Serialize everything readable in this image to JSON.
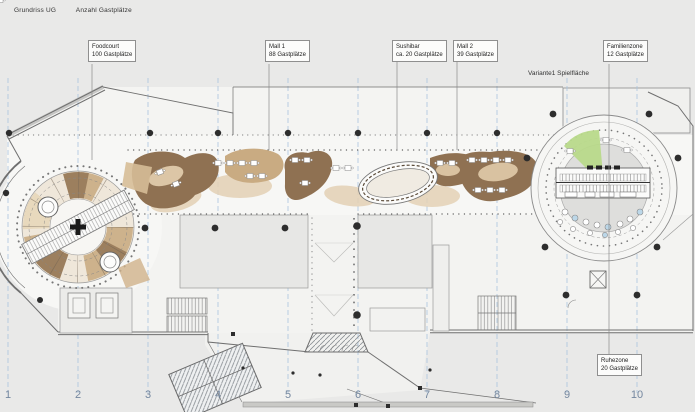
{
  "title": {
    "main": "Grundriss UG",
    "sub": "Anzahl Gastplätze"
  },
  "annotations": [
    {
      "id": "foodcourt",
      "line1": "Foodcourt",
      "line2": "100 Gastplätze"
    },
    {
      "id": "mall1",
      "line1": "Mall 1",
      "line2": "88 Gastplätze"
    },
    {
      "id": "sushibar",
      "line1": "Sushibar",
      "line2": "ca. 20 Gastplätze"
    },
    {
      "id": "mall2",
      "line1": "Mall 2",
      "line2": "39 Gastplätze"
    },
    {
      "id": "familienzone",
      "line1": "Familienzone",
      "line2": "12 Gastplätze"
    },
    {
      "id": "ruhezone",
      "line1": "Ruhezone",
      "line2": "20 Gastplätze"
    }
  ],
  "variant_note": "Variante1  Spielfläche",
  "axis_labels": [
    "1",
    "2",
    "3",
    "4",
    "5",
    "6",
    "7",
    "8",
    "9",
    "10"
  ],
  "colors": {
    "background": "#e9e9e8",
    "plan_white": "#f7f7f5",
    "grid_blue": "#a9c4de",
    "axis_number_blue": "#74879f",
    "column_black": "#2d2d2d",
    "furniture_dark_brown": "#8f7152",
    "furniture_mid_brown": "#c9ab82",
    "furniture_light_tan": "#e4d1b5",
    "play_green": "#b8d98a",
    "wall_gray": "#777777"
  }
}
